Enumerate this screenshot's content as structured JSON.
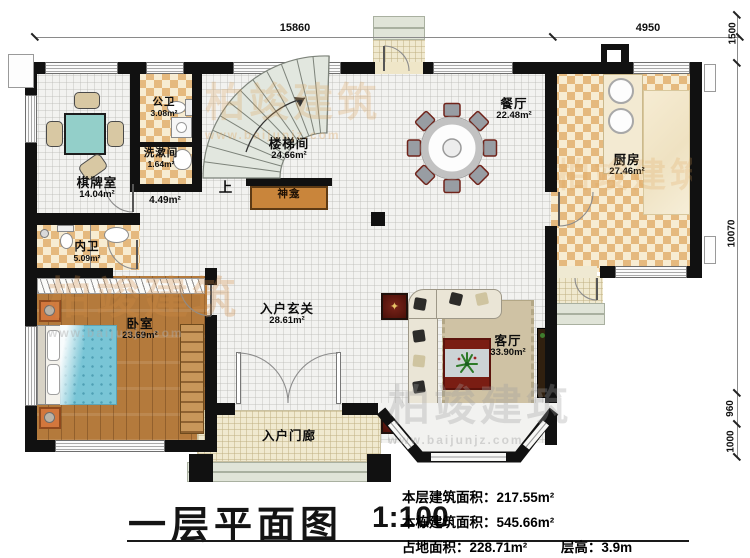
{
  "title_block": {
    "title": "一层平面图",
    "scale": "1:100",
    "line1_label": "本层建筑面积：",
    "line1_value": "217.55m²",
    "line2_label": "本栋建筑面积：",
    "line2_value": "545.66m²",
    "line3a_label": "占地面积：",
    "line3a_value": "228.71m²",
    "line3b_label": "层高：",
    "line3b_value": "3.9m"
  },
  "rooms": {
    "qipai": {
      "name": "棋牌室",
      "area": "14.04m²"
    },
    "gongwei": {
      "name": "公卫",
      "area": "3.08m²"
    },
    "xishujian": {
      "name": "洗漱间",
      "area": "1.64m²"
    },
    "loutijian": {
      "name": "楼梯间",
      "area": "24.66m²"
    },
    "corridor": {
      "area": "4.49m²"
    },
    "canting": {
      "name": "餐厅",
      "area": "22.48m²"
    },
    "chufang": {
      "name": "厨房",
      "area": "27.46m²"
    },
    "neiwei": {
      "name": "内卫",
      "area": "5.09m²"
    },
    "woshi": {
      "name": "卧室",
      "area": "23.69m²"
    },
    "xuanguan": {
      "name": "入户玄关",
      "area": "28.61m²"
    },
    "keting": {
      "name": "客厅",
      "area": "33.90m²"
    },
    "menlang": {
      "name": "入户门廊"
    },
    "shenkan": {
      "name": "神龛"
    }
  },
  "annotations": {
    "up": "上"
  },
  "dimensions": {
    "top": [
      "15860",
      "4950"
    ],
    "right": [
      "1500",
      "10070",
      "960",
      "1000"
    ]
  },
  "watermark": {
    "brand": "柏竣建筑",
    "url": "www.baijunjz.com"
  },
  "icons": {
    "star_ornament": "✦"
  },
  "colors": {
    "wall": "#111111",
    "checker_tan": "#e5b97e",
    "checker_cream": "#f7ecd2",
    "wood_floor": "#b47a3c",
    "bed_blue": "#79c5d6",
    "mahjong_teal": "#93cfc9",
    "shrine_orange": "#c9853b",
    "watermark_orange": "#e0a055"
  }
}
